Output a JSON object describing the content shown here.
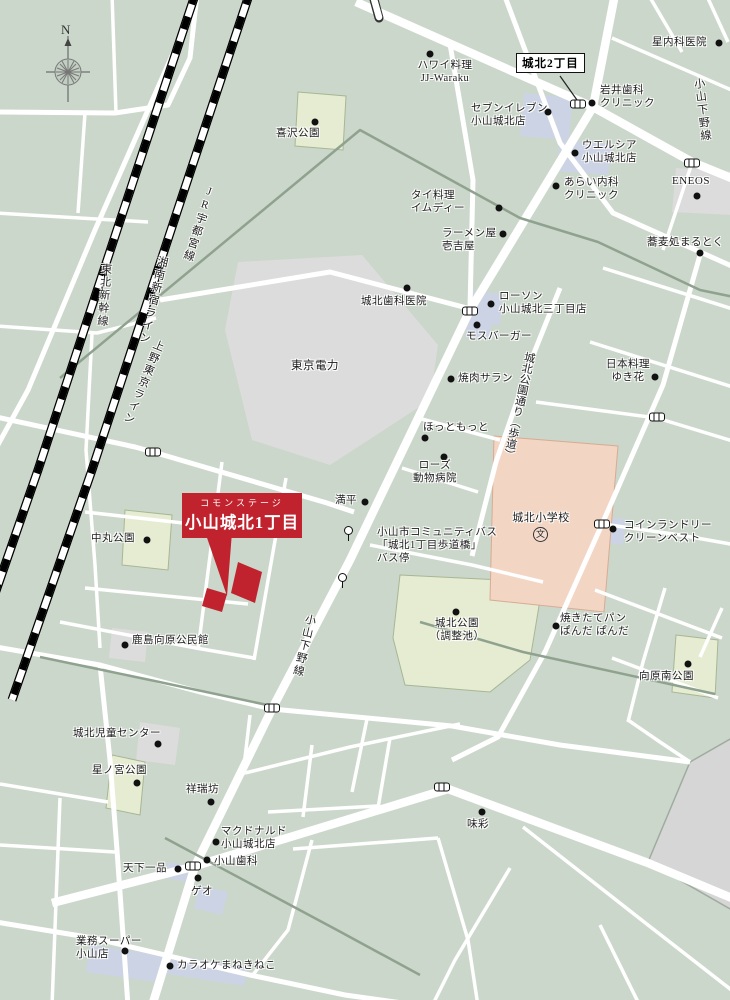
{
  "compass": {
    "north": "N"
  },
  "area_sign": {
    "label": "城北2丁目"
  },
  "callout": {
    "brand": "コモンステージ",
    "name": "小山城北1丁目"
  },
  "railway_labels": [
    {
      "label": "JR宇都宮線"
    },
    {
      "label": "東北新幹線"
    },
    {
      "label": "湘南新宿ライン"
    },
    {
      "label": "上野東京ライン"
    }
  ],
  "road_labels": [
    {
      "label": "小山下野線"
    },
    {
      "label": "小山下野線"
    },
    {
      "label": "城北公園通り（歩道）"
    }
  ],
  "colors": {
    "background": "#cbd7ca",
    "road": "#ffffff",
    "park": "#e6ecd2",
    "school": "#f3d5c3",
    "building_gray": "#dcdcdc",
    "building_blue": "#ccd3e4",
    "accent_red": "#c1232e",
    "waterline_gray": "#8fa28f"
  },
  "pois": [
    {
      "label": "ハワイ料理\nJJ-Waraku"
    },
    {
      "label": "星内科医院"
    },
    {
      "label": "岩井歯科\nクリニック"
    },
    {
      "label": "セブンイレブン\n小山城北店"
    },
    {
      "label": "ウエルシア\n小山城北店"
    },
    {
      "label": "あらい内科\nクリニック"
    },
    {
      "label": "ENEOS"
    },
    {
      "label": "蕎麦処まるとく"
    },
    {
      "label": "タイ料理\nイムディー"
    },
    {
      "label": "ラーメン屋\n壱吉屋"
    },
    {
      "label": "城北歯科医院"
    },
    {
      "label": "ローソン\n小山城北三丁目店"
    },
    {
      "label": "モスバーガー"
    },
    {
      "label": "焼肉サラン"
    },
    {
      "label": "日本料理\nゆき花"
    },
    {
      "label": "ほっともっと"
    },
    {
      "label": "ローズ\n動物病院"
    },
    {
      "label": "満平"
    },
    {
      "label": "小山市コミュニティバス\n「城北1丁目歩道橋」\nバス停"
    },
    {
      "label": "東京電力"
    },
    {
      "label": "中丸公園"
    },
    {
      "label": "城北小学校"
    },
    {
      "label": "文"
    },
    {
      "label": "コインランドリー\nクリーンベスト"
    },
    {
      "label": "焼きたてパン\nぱんだ ぱんだ"
    },
    {
      "label": "城北公園\n（調整池）"
    },
    {
      "label": "向原南公園"
    },
    {
      "label": "鹿島向原公民館"
    },
    {
      "label": "城北児童センター"
    },
    {
      "label": "星ノ宮公園"
    },
    {
      "label": "祥瑞坊"
    },
    {
      "label": "味彩"
    },
    {
      "label": "マクドナルド\n小山城北店"
    },
    {
      "label": "小山歯科"
    },
    {
      "label": "天下一品"
    },
    {
      "label": "ゲオ"
    },
    {
      "label": "業務スーパー\n小山店"
    },
    {
      "label": "カラオケまねきねこ"
    },
    {
      "label": "喜沢公園"
    }
  ]
}
